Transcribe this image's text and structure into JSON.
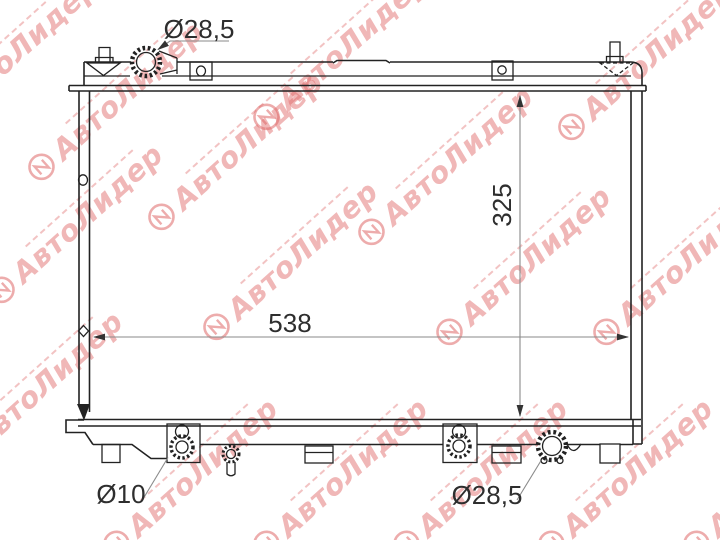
{
  "watermark": {
    "brand": "АвтоЛидер",
    "color": "#e06a6a"
  },
  "drawing": {
    "dimensions": {
      "filler_neck_diameter": "Ø28,5",
      "core_height": "325",
      "core_width": "538",
      "drain_diameter": "Ø10",
      "outlet_diameter": "Ø28,5"
    }
  }
}
